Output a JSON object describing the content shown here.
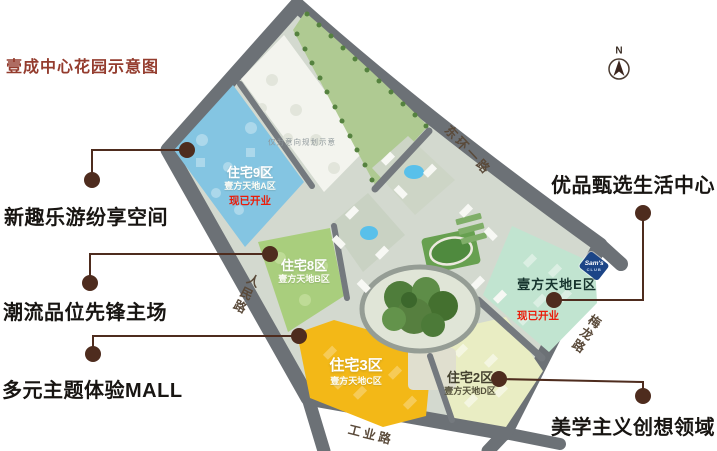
{
  "title": "壹成中心花园示意图",
  "compass": "N",
  "annotations": {
    "left": [
      "新趣乐游纷享空间",
      "潮流品位先锋主场",
      "多元主题体验MALL"
    ],
    "right": [
      "优品甄选生活中心",
      "美学主义创想领域"
    ]
  },
  "map": {
    "disclaimer": "仅为意向规划示意",
    "zones": {
      "a": {
        "name": "住宅9区",
        "subtitle": "壹方天地A区",
        "status": "现已开业",
        "color": "#84c5e2"
      },
      "b": {
        "name": "住宅8区",
        "subtitle": "壹方天地B区",
        "color": "#a9ce7d"
      },
      "c": {
        "name": "住宅3区",
        "subtitle": "壹方天地C区",
        "color": "#f3b817"
      },
      "d": {
        "name": "住宅2区",
        "subtitle": "壹方天地D区",
        "color": "#e9edc3"
      },
      "e": {
        "name": "壹方天地E区",
        "status": "现已开业",
        "color": "#c1e4d0",
        "store_badge": {
          "brand": "Sam's",
          "sub": "CLUB"
        }
      }
    },
    "roads": {
      "northeast": "东环一路",
      "west": "人民路",
      "south": "工业路",
      "east": "梅龙路"
    }
  },
  "colors": {
    "title_red": "#943c2e",
    "connector_brown": "#4e2c1e",
    "road_gray": "#6c7176",
    "status_red": "#ea1d0b",
    "sams_blue": "#1c4587"
  }
}
